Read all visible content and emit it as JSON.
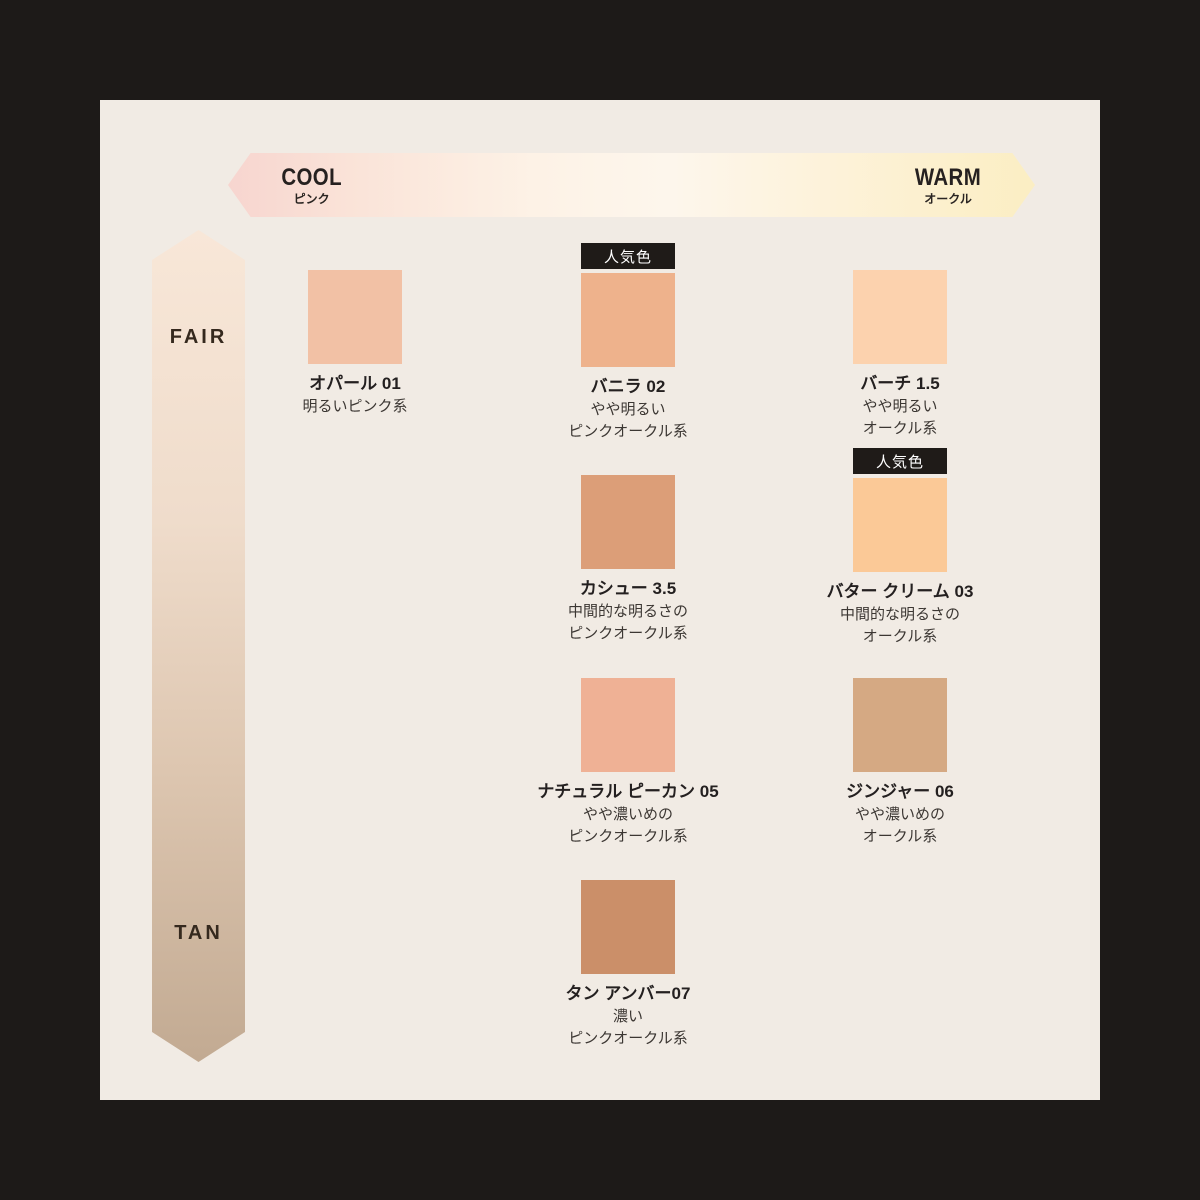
{
  "labels": {
    "popular_badge": "人気色"
  },
  "horizontal_axis": {
    "left_label": "COOL",
    "left_sublabel": "ピンク",
    "right_label": "WARM",
    "right_sublabel": "オークル",
    "gradient_colors": [
      "#f7d5cf",
      "#fdf5ea",
      "#fbeec3"
    ]
  },
  "vertical_axis": {
    "top_label": "FAIR",
    "bottom_label": "TAN",
    "gradient_colors": [
      "#f8e7d8",
      "#c2aa92"
    ]
  },
  "colors": {
    "frame": "#1d1a18",
    "panel_background": "#f1ebe4",
    "badge_background": "#1f1b18",
    "badge_text": "#ffffff"
  },
  "shades": [
    {
      "name": "オパール 01",
      "desc1": "明るいピンク系",
      "desc2": "",
      "color": "#f2c1a5",
      "popular": false
    },
    {
      "name": "バニラ 02",
      "desc1": "やや明るい",
      "desc2": "ピンクオークル系",
      "color": "#eeb28c",
      "popular": true
    },
    {
      "name": "バーチ 1.5",
      "desc1": "やや明るい",
      "desc2": "オークル系",
      "color": "#fcd2ae",
      "popular": false
    },
    {
      "name": "カシュー 3.5",
      "desc1": "中間的な明るさの",
      "desc2": "ピンクオークル系",
      "color": "#dc9e78",
      "popular": false
    },
    {
      "name": "バター クリーム 03",
      "desc1": "中間的な明るさの",
      "desc2": "オークル系",
      "color": "#fbc997",
      "popular": true
    },
    {
      "name": "ナチュラル ピーカン 05",
      "desc1": "やや濃いめの",
      "desc2": "ピンクオークル系",
      "color": "#efb195",
      "popular": false
    },
    {
      "name": "ジンジャー 06",
      "desc1": "やや濃いめの",
      "desc2": "オークル系",
      "color": "#d5a983",
      "popular": false
    },
    {
      "name": "タン アンバー07",
      "desc1": "濃い",
      "desc2": "ピンクオークル系",
      "color": "#cb8f69",
      "popular": false
    }
  ]
}
